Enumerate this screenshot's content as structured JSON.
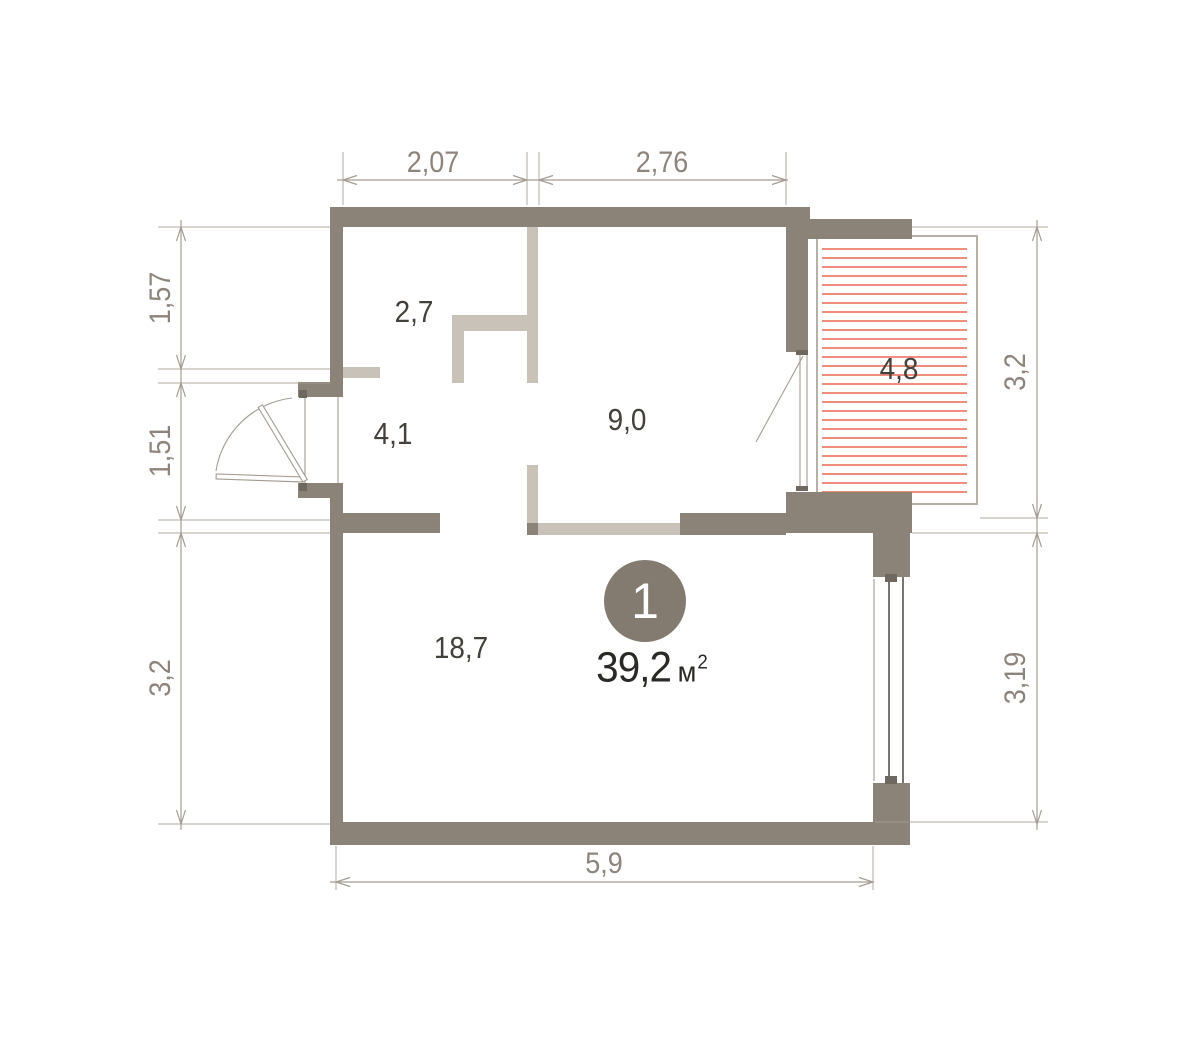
{
  "floorplan": {
    "unit_badge": {
      "number": "1",
      "area_value": "39,2",
      "area_unit": "м",
      "area_exponent": "2"
    },
    "rooms": {
      "closet": "2,7",
      "hallway": "4,1",
      "bedroom": "9,0",
      "balcony": "4,8",
      "living_room": "18,7"
    },
    "dimensions": {
      "top": [
        "2,07",
        "2,76"
      ],
      "left": [
        "1,57",
        "1,51",
        "3,2"
      ],
      "right": [
        "3,2",
        "3,19"
      ],
      "bottom": [
        "5,9"
      ]
    },
    "colors": {
      "wall_dark": "#8b8278",
      "wall_light": "#c8c2b9",
      "dimension_line": "#a49c92",
      "dimension_text": "#8d857b",
      "room_label": "#44403a",
      "area_text": "#2b2926",
      "unit_circle": "#847b70",
      "hatch_red": "#ef8e7e",
      "balcony_border": "#b6b0a7"
    }
  }
}
